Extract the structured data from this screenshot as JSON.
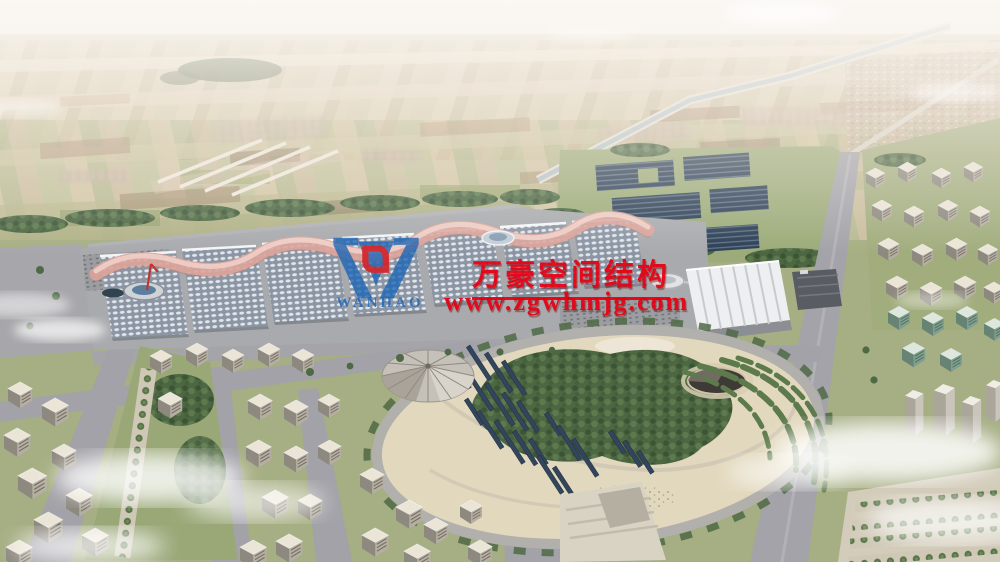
{
  "watermark": {
    "company_name_cn": "万豪空间结构",
    "website": "www.zgwhmjg.com",
    "logo_text": "WANHAO",
    "logo_icon": "wanhao-w-logo",
    "colors": {
      "brand_red": "#e60012",
      "brand_blue": "#1d66b5"
    }
  }
}
